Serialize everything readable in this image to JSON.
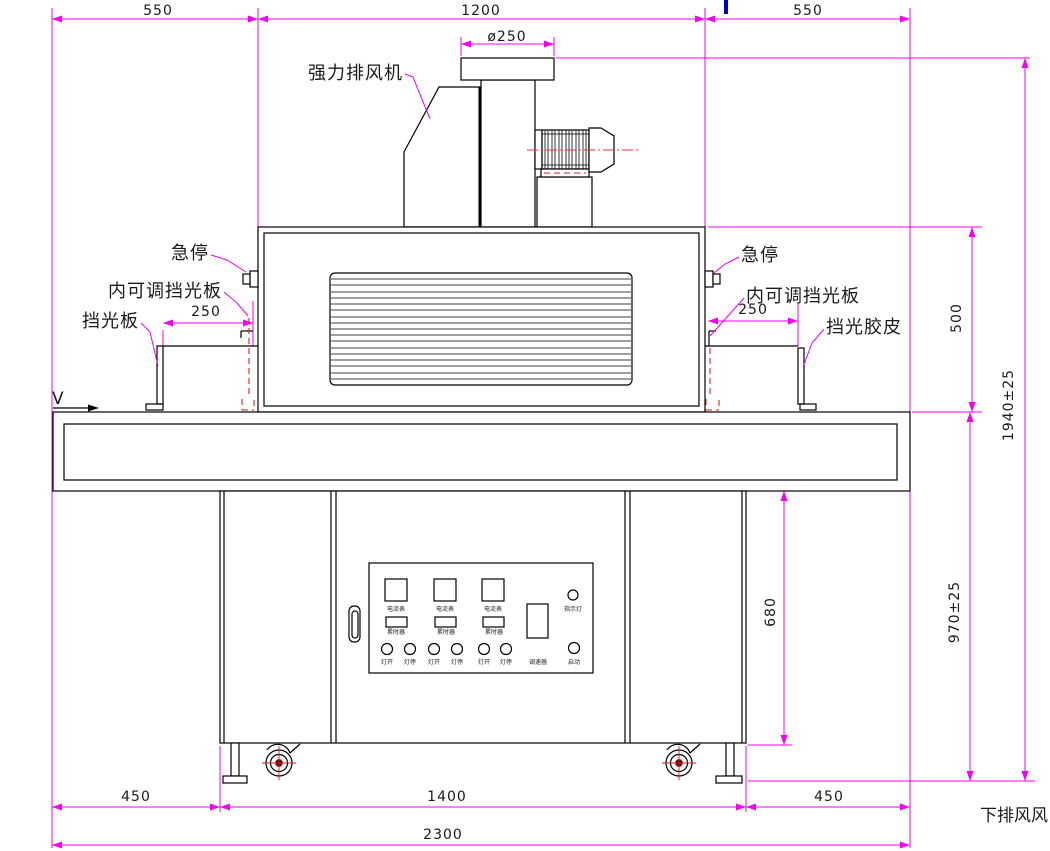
{
  "dims": {
    "top_left": "550",
    "top_span": "1200",
    "top_right": "550",
    "flange": "ø250",
    "left_offset": "250",
    "right_offset": "250",
    "chamber_height": "500",
    "overall_height": "1940±25",
    "table_height": "970±25",
    "cabinet_height": "680",
    "bottom_left": "450",
    "bottom_span": "1400",
    "bottom_right": "450",
    "overall_width": "2300"
  },
  "labels": {
    "exhaust_fan": "强力排风机",
    "estop": "急停",
    "inner_shield": "内可调挡光板",
    "shield_plate": "挡光板",
    "shield_rubber": "挡光胶皮",
    "direction": "V",
    "bottom_note": "下排风风"
  },
  "panel": {
    "ammeters": [
      "电流表",
      "电流表",
      "电流表"
    ],
    "timers": [
      "累时器",
      "累时器",
      "累时器"
    ],
    "lamp_buttons": [
      "灯开",
      "灯停",
      "灯开",
      "灯停",
      "灯开",
      "灯停"
    ],
    "indicator": "指示灯",
    "speed": "调速器",
    "start": "启动"
  },
  "colors": {
    "dimension": "#f400f4",
    "geometry": "#000000",
    "hidden_line": "#cc2222",
    "centerline": "#ee3333",
    "blue_mark": "#0000cc",
    "background": "#ffffff"
  }
}
